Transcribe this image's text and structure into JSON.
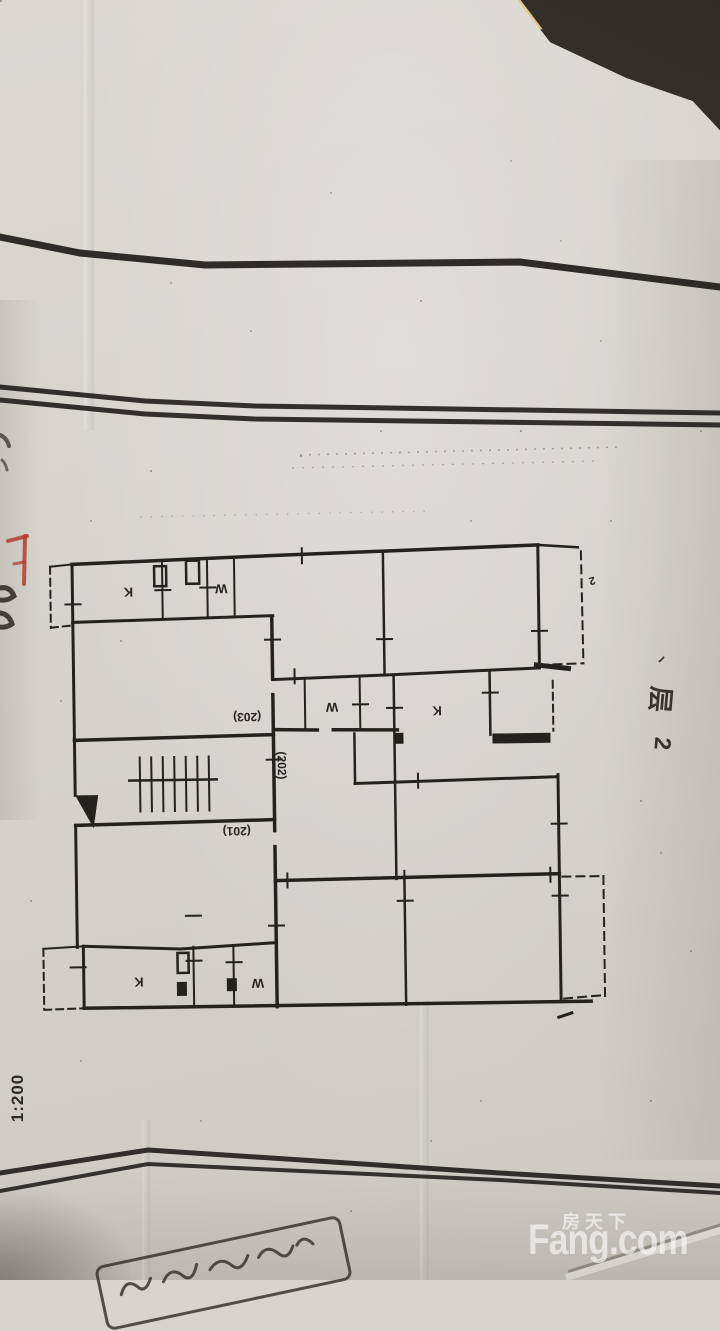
{
  "watermark": {
    "brand_cn": "房天下",
    "brand_en": "Fang.com"
  },
  "drawing": {
    "scale_label": "1:200",
    "unit_numbers": {
      "n203": "(203)",
      "n202": "(202)",
      "n201": "(201)"
    },
    "room_labels": {
      "k_top": "K",
      "w_top": "W",
      "k_mid": "K",
      "w_mid": "W",
      "k_bottom": "K",
      "w_bottom": "W"
    },
    "corner_mark": "2",
    "handwritten_floor_note": [
      "丶",
      "层",
      "2"
    ]
  },
  "colors": {
    "table_wood": "#3b372f",
    "table_edge_highlight": "#e7c488",
    "paper": "#d7d4ce",
    "ink": "#24221d",
    "red_annotation": "#b13527",
    "watermark": "#ffffff"
  }
}
